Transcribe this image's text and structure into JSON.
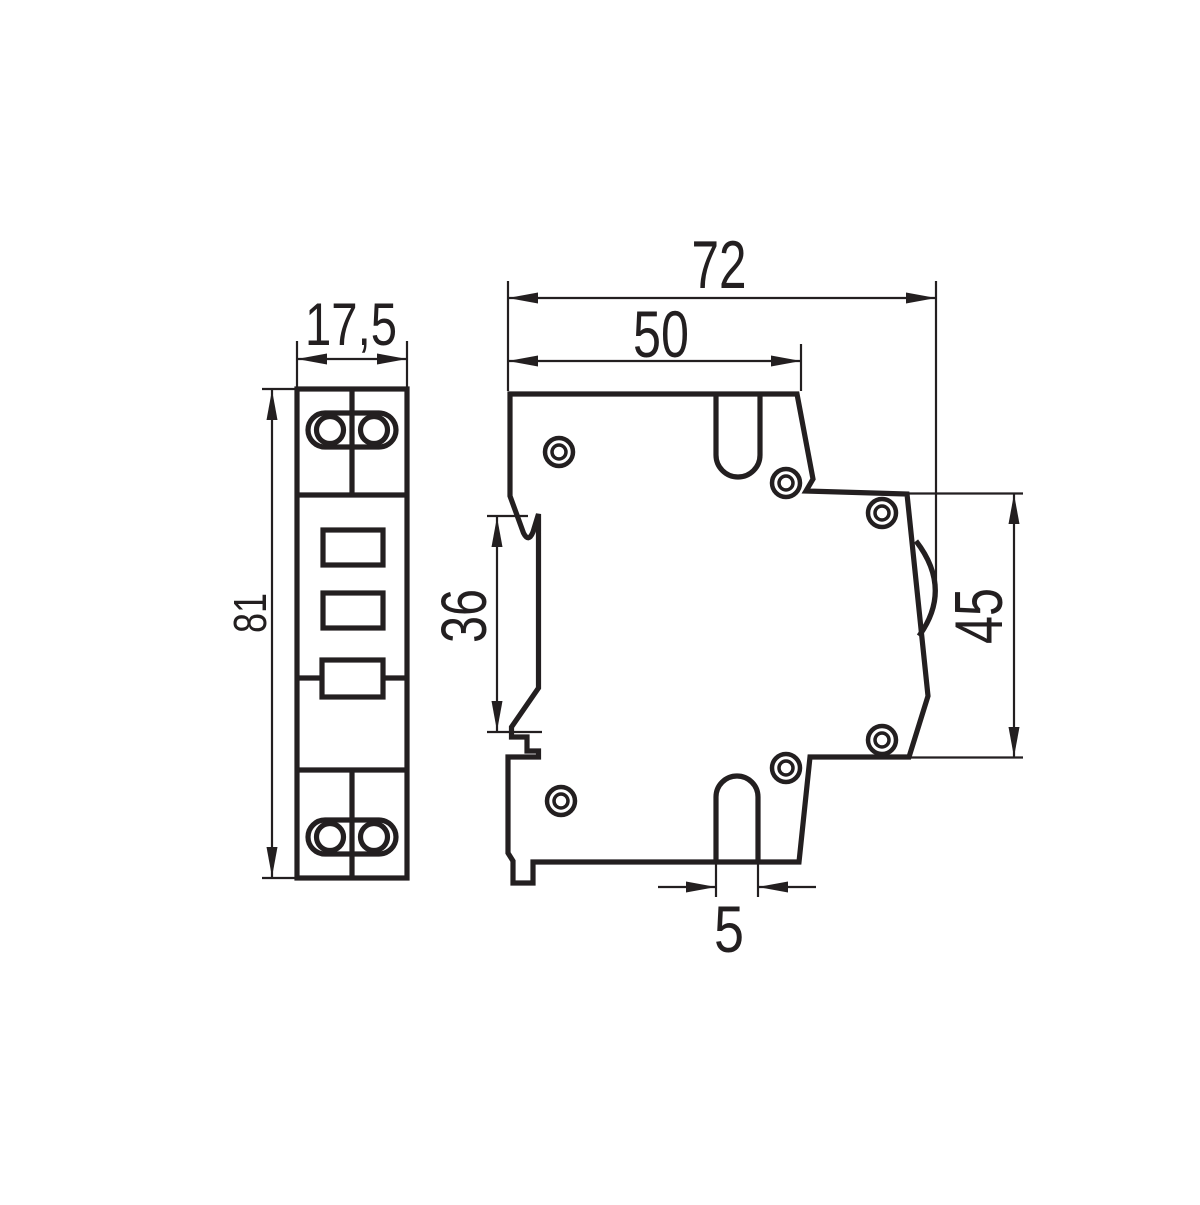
{
  "diagram": {
    "dimensions": {
      "front_width": "17,5",
      "front_height": "81",
      "depth_total": "72",
      "depth_upper": "50",
      "din_slot_height": "36",
      "front_panel_height": "45",
      "slot_width": "5"
    },
    "colors": {
      "line": "#231f20",
      "background": "#ffffff"
    }
  }
}
